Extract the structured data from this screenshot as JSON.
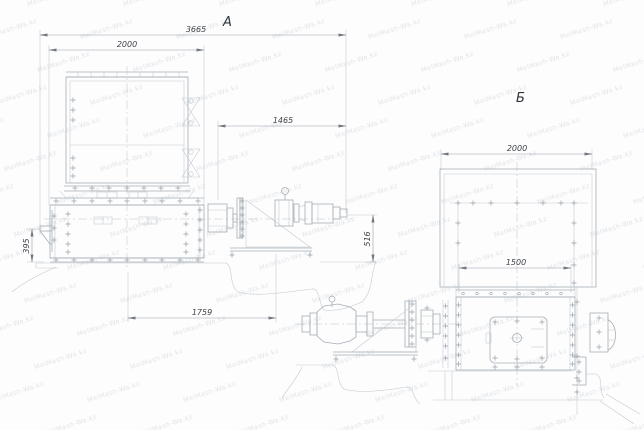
{
  "drawing": {
    "background": "#fdfdfe",
    "line_color": "#a6afb6",
    "dim_text_color": "#3f444a",
    "watermark": {
      "text": "MelMash-Wa.kz",
      "color": "#e1e4e7"
    },
    "view_a": {
      "label": "А",
      "dims": {
        "overall_length": "3665",
        "tank_width": "2000",
        "drive_length": "1465",
        "base_length": "1759",
        "bracket_height": "395",
        "drive_height": "516"
      }
    },
    "view_b": {
      "label": "Б",
      "dims": {
        "hopper_width": "2000",
        "housing_length": "1500"
      }
    }
  }
}
